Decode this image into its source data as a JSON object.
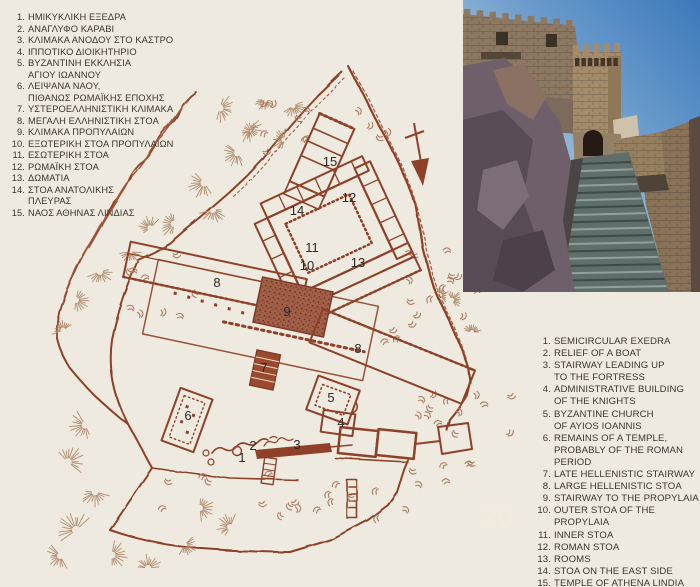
{
  "colors": {
    "page_background": "#efeae0",
    "map_ink": "#8e4128",
    "map_fill": "#a2604a",
    "vegetation": "#b1805f",
    "legend_text": "#3a3530",
    "label_text": "#2c2824"
  },
  "legend_greek": {
    "items": [
      {
        "n": "1.",
        "lines": [
          "ΗΜΙΚΥΚΛΙΚΗ ΕΞΕΔΡΑ"
        ]
      },
      {
        "n": "2.",
        "lines": [
          "ΑΝΑΓΛΥΦΟ ΚΑΡΑΒΙ"
        ]
      },
      {
        "n": "3.",
        "lines": [
          "ΚΛΙΜΑΚΑ ΑΝΟΔΟΥ ΣΤΟ ΚΑΣΤΡΟ"
        ]
      },
      {
        "n": "4.",
        "lines": [
          "ΙΠΠΟΤΙΚΟ ΔΙΟΙΚΗΤΗΡΙΟ"
        ]
      },
      {
        "n": "5.",
        "lines": [
          "ΒΥΖΑΝΤΙΝΗ ΕΚΚΛΗΣΙΑ",
          "ΑΓΙΟΥ ΙΩΑΝΝΟΥ"
        ]
      },
      {
        "n": "6.",
        "lines": [
          "ΛΕΙΨΑΝΑ ΝΑΟΥ,",
          "ΠΙΘΑΝΩΣ ΡΩΜΑΪΚΗΣ ΕΠΟΧΗΣ"
        ]
      },
      {
        "n": "7.",
        "lines": [
          "ΥΣΤΕΡΟΕΛΛΗΝΙΣΤΙΚΗ ΚΛΙΜΑΚΑ"
        ]
      },
      {
        "n": "8.",
        "lines": [
          "ΜΕΓΑΛΗ ΕΛΛΗΝΙΣΤΙΚΗ ΣΤΟΑ"
        ]
      },
      {
        "n": "9.",
        "lines": [
          "ΚΛΙΜΑΚΑ ΠΡΟΠΥΛΑΙΩΝ"
        ]
      },
      {
        "n": "10.",
        "lines": [
          "ΕΞΩΤΕΡΙΚΗ ΣΤΟΑ ΠΡΟΠΥΛΑΙΩΝ"
        ]
      },
      {
        "n": "11.",
        "lines": [
          "ΕΣΩΤΕΡΙΚΗ ΣΤΟΑ"
        ]
      },
      {
        "n": "12.",
        "lines": [
          "ΡΩΜΑΪΚΗ ΣΤΟΑ"
        ]
      },
      {
        "n": "13.",
        "lines": [
          "ΔΩΜΑΤΙΑ"
        ]
      },
      {
        "n": "14.",
        "lines": [
          "ΣΤΟΑ ΑΝΑΤΟΛΙΚΗΣ",
          "ΠΛΕΥΡΑΣ"
        ]
      },
      {
        "n": "15.",
        "lines": [
          "ΝΑΟΣ ΑΘΗΝΑΣ ΛΙΝΔΙΑΣ"
        ]
      }
    ]
  },
  "legend_english": {
    "items": [
      {
        "n": "1.",
        "lines": [
          "SEMICIRCULAR EXEDRA"
        ]
      },
      {
        "n": "2.",
        "lines": [
          "RELIEF OF A BOAT"
        ]
      },
      {
        "n": "3.",
        "lines": [
          "STAIRWAY LEADING UP",
          "TO THE FORTRESS"
        ]
      },
      {
        "n": "4.",
        "lines": [
          "ADMINISTRATIVE BUILDING",
          "OF THE KNIGHTS"
        ]
      },
      {
        "n": "5.",
        "lines": [
          "BYZANTINE CHURCH",
          "OF AYIOS IOANNIS"
        ]
      },
      {
        "n": "6.",
        "lines": [
          "REMAINS OF A TEMPLE,",
          "PROBABLY OF THE ROMAN PERIOD"
        ]
      },
      {
        "n": "7.",
        "lines": [
          "LATE HELLENISTIC STAIRWAY"
        ]
      },
      {
        "n": "8.",
        "lines": [
          "LARGE HELLENISTIC STOA"
        ]
      },
      {
        "n": "9.",
        "lines": [
          "STAIRWAY TO THE PROPYLAIA"
        ]
      },
      {
        "n": "10.",
        "lines": [
          "OUTER STOA OF THE PROPYLAIA"
        ]
      },
      {
        "n": "11.",
        "lines": [
          "INNER STOA"
        ]
      },
      {
        "n": "12.",
        "lines": [
          "ROMAN STOA"
        ]
      },
      {
        "n": "13.",
        "lines": [
          "ROOMS"
        ]
      },
      {
        "n": "14.",
        "lines": [
          "STOA ON THE EAST SIDE"
        ]
      },
      {
        "n": "15.",
        "lines": [
          "TEMPLE OF ATHENA LINDIA"
        ]
      }
    ]
  },
  "map": {
    "watermark": "20",
    "labels": [
      {
        "n": "15",
        "x": 330,
        "y": 166
      },
      {
        "n": "12",
        "x": 349,
        "y": 202
      },
      {
        "n": "14",
        "x": 297,
        "y": 215
      },
      {
        "n": "11",
        "x": 312,
        "y": 252
      },
      {
        "n": "10",
        "x": 307,
        "y": 270
      },
      {
        "n": "13",
        "x": 358,
        "y": 267
      },
      {
        "n": "8",
        "x": 217,
        "y": 287
      },
      {
        "n": "9",
        "x": 287,
        "y": 316
      },
      {
        "n": "8",
        "x": 358,
        "y": 353
      },
      {
        "n": "7",
        "x": 264,
        "y": 372
      },
      {
        "n": "5",
        "x": 331,
        "y": 402
      },
      {
        "n": "6",
        "x": 188,
        "y": 420
      },
      {
        "n": "4",
        "x": 341,
        "y": 427
      },
      {
        "n": "3",
        "x": 297,
        "y": 449
      },
      {
        "n": "2",
        "x": 253,
        "y": 450
      },
      {
        "n": "1",
        "x": 242,
        "y": 462
      }
    ]
  }
}
